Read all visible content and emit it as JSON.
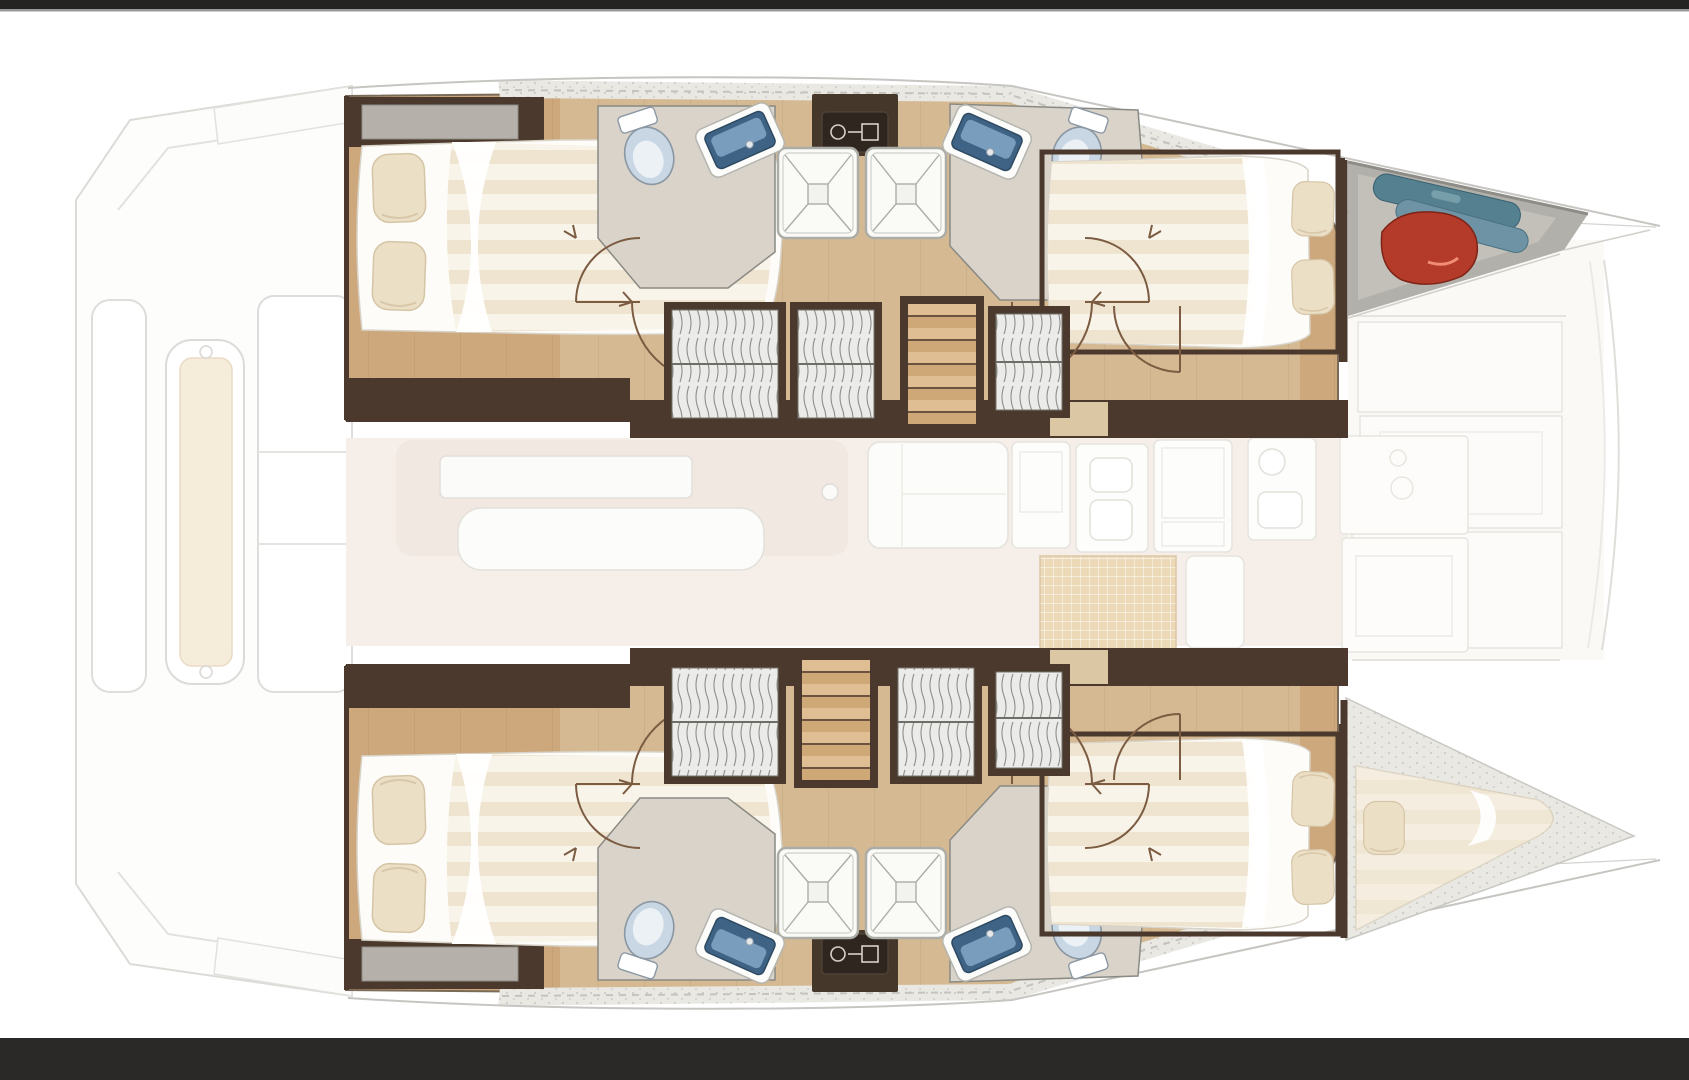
{
  "window": {
    "description": "Top-down interior layout plan of a sailing catamaran, letterboxed between dark bars"
  },
  "palette": {
    "frame_top": "#242321",
    "frame_rule": "#6f6e6c",
    "frame_bottom": "#2a2927",
    "wood": "#cda87d",
    "wood_light": "#dcc7a4",
    "wall_dark": "#4a392c",
    "bath_floor": "#d9d3ca",
    "bed_white": "#fdfcf8",
    "duvet_a": "#eee4cf",
    "duvet_b": "#f9f4e9",
    "pillow": "#ebdfc6",
    "pillow_edge": "#d5c5a6",
    "toilet_fill": "#c8d7e3",
    "toilet_rim": "#8b98a4",
    "toilet_inner": "#ebf1f5",
    "sink_rim": "#fcfcfa",
    "sink_basin": "#3f6384",
    "sink_glass": "#7fa3c2",
    "shower_fill": "#fafaf7",
    "shower_line": "#adada7",
    "wardrobe_bg": "#ebebe9",
    "wardrobe_line": "#8e8e8c",
    "stair_wood": "#cfa878",
    "stair_step": "#debe92",
    "stair_line": "#6b5340",
    "equip_dark": "#453729",
    "equip_inner": "#2f2620",
    "equip_icon": "#d6d0c6",
    "bag_red": "#b43a29",
    "bag_red_hi": "#ef8d76",
    "fender_a": "#54808f",
    "fender_b": "#6d93a4",
    "salon": "#f6efe9",
    "salon_item": "#f0e8e1",
    "ghost_fill": "#fdfdfc",
    "ghost_stroke": "#dcdbd7",
    "ghost_cream": "#f6ecda",
    "deck_band": "#e9e8e3",
    "deck_dash": "#c4c3be",
    "bow_floor": "#b2b0aa",
    "bow_floor_hi": "#c5c3bd",
    "forepeak": "#e0dfda",
    "arc": "#7b5b41",
    "outline": "#c6c5c1",
    "grid_mat": "#ecd9b8",
    "mat_edge": "#d9c7a7",
    "berth": "#efe7d8"
  },
  "floorplan": {
    "vessel_type": "sailing catamaran",
    "view": "top-down interior deck plan",
    "layout": "4 double cabins, 4 heads, 2 companionway stairs, bow skipper berth",
    "port_hull": {
      "aft_cabin": [
        "double bed",
        "2 pillows",
        "headboard locker"
      ],
      "head_aft": [
        "toilet",
        "vanity sink"
      ],
      "showers": 2,
      "equipment_unit": "dark technical box between showers",
      "head_fwd": [
        "vanity sink",
        "toilet"
      ],
      "wardrobes": 3,
      "stairs": "companionway from salon",
      "fwd_cabin": [
        "double bed",
        "2 pillows"
      ],
      "bow_locker": [
        "red gear bag",
        "2 blue fenders"
      ]
    },
    "starboard_hull": {
      "aft_cabin": [
        "double bed",
        "2 pillows",
        "headboard locker"
      ],
      "head_aft": [
        "toilet",
        "vanity sink"
      ],
      "showers": 2,
      "equipment_unit": "dark technical box between showers",
      "head_fwd": [
        "vanity sink",
        "toilet"
      ],
      "wardrobes": 3,
      "stairs": "companionway from salon",
      "fwd_cabin": [
        "double bed",
        "2 pillows"
      ],
      "bow_berth": [
        "single v-berth",
        "pillow"
      ]
    },
    "bridgedeck": {
      "salon": [
        "L-shaped sofa block",
        "table",
        "bench seat"
      ],
      "galley": [
        "cabinet",
        "appliance column",
        "double sink unit",
        "grid mat"
      ],
      "fwd_lockers": [
        "locker panels",
        "faint stove outline"
      ],
      "aft_cockpit_ghost": [
        "transom steps",
        "helm bench with cushion",
        "side seats",
        "coachroof edges"
      ],
      "bow_ghost": [
        "crossbeam panels",
        "bowsprit lines",
        "two bow tips"
      ]
    },
    "fixture_totals": {
      "double_beds": 4,
      "single_berths": 1,
      "toilets": 4,
      "sinks": 4,
      "showers": 4,
      "wardrobes": 6,
      "staircases": 2
    }
  }
}
